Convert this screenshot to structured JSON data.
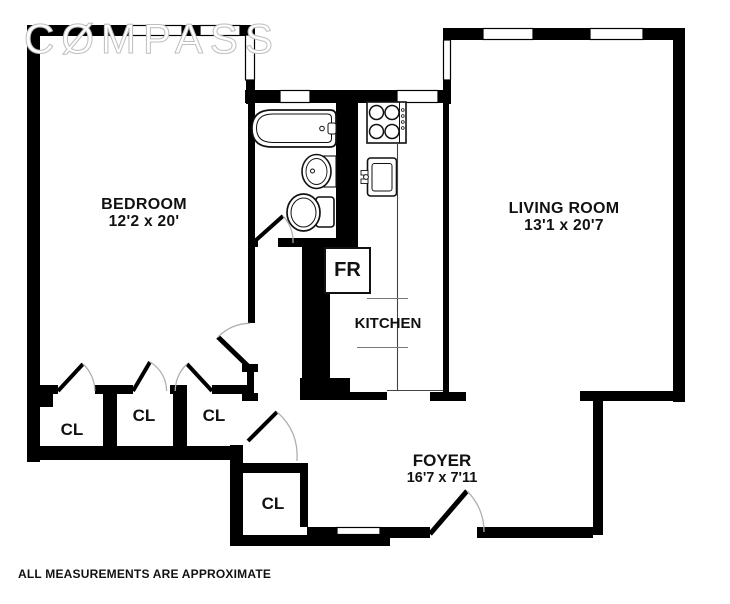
{
  "brand": {
    "logo_text": "CØMPASS"
  },
  "rooms": {
    "bedroom": {
      "name": "BEDROOM",
      "dims": "12'2 x 20'"
    },
    "living_room": {
      "name": "LIVING ROOM",
      "dims": "13'1 x 20'7"
    },
    "kitchen": {
      "name": "KITCHEN"
    },
    "foyer": {
      "name": "FOYER",
      "dims": "16'7 x 7'11"
    },
    "fridge": {
      "label": "FR"
    }
  },
  "closets": [
    {
      "label": "CL"
    },
    {
      "label": "CL"
    },
    {
      "label": "CL"
    },
    {
      "label": "CL"
    }
  ],
  "footer": {
    "disclaimer": "ALL MEASUREMENTS ARE APPROXIMATE"
  },
  "colors": {
    "wall": "#000000",
    "background": "#ffffff",
    "door_arc": "#b0b0b0"
  }
}
